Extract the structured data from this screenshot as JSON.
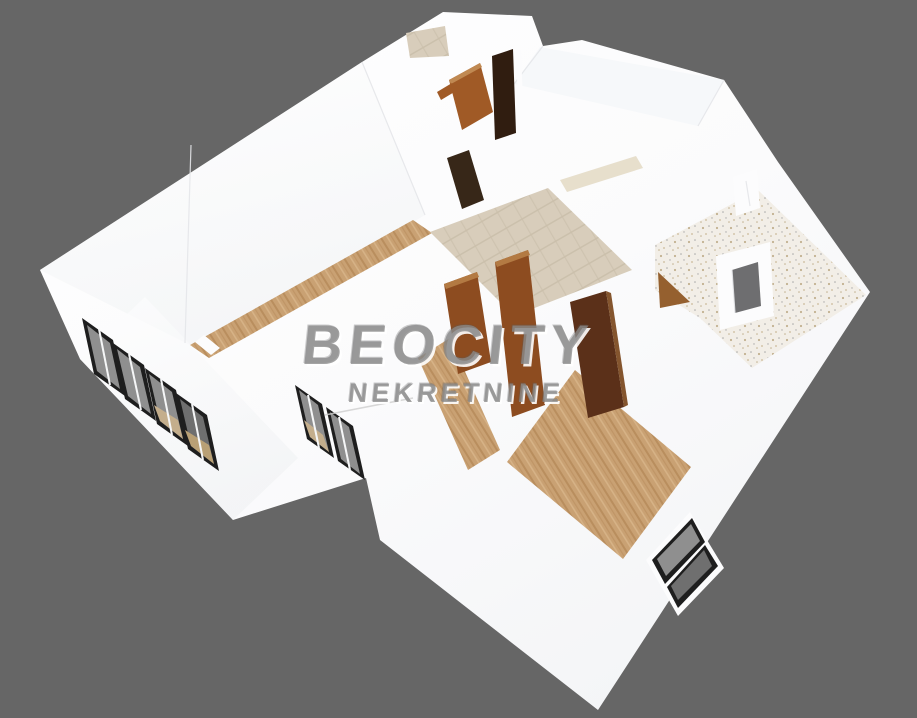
{
  "watermark": {
    "title": "BEOCITY",
    "subtitle": "NEKRETNINE"
  },
  "scene": {
    "type": "3d-floor-plan-render",
    "rooms_visible": "apartment interior with wood, tile and terrazzo floors, open wooden doors, window bands"
  },
  "palette": {
    "background": "#666666",
    "wall_bright": "#fcfcfd",
    "edge": "#e4e6e9",
    "sill": "#e7dfcc",
    "wood_base": "#c9a173",
    "wood_dark": "#b98e5e",
    "wood_light": "#d6b286",
    "tile_base": "#d8cdbb",
    "tile_line": "#cbc0ac",
    "terrazzo_base": "#f2eee7",
    "terrazzo_dot1": "#c2b190",
    "terrazzo_dot2": "#a9a9a9",
    "terrazzo_dot3": "#cbb998",
    "window_frame": "#1e1e1e",
    "window_hole": "#6e6e70",
    "glass": "#8f8f8f",
    "glass_dark": "#6f6f6f",
    "glass_warm": "#c4ae8c",
    "glass_warm2": "#b9a075",
    "mullion": "#f5f6f7",
    "door_oak": "#a05a26",
    "door_oak_light": "#c08952",
    "door_chestnut": "#8d4c20",
    "door_chestnut_light": "#b37a43",
    "door_mahogany": "#5b3019",
    "door_mahogany_light": "#84552e",
    "door_walnut": "#301d10",
    "door_dark_opening": "#372718",
    "door_tan": "#95602f",
    "watermark_fill": "rgba(138,138,138,0.78)",
    "watermark_hi": "rgba(255,255,255,0.9)",
    "watermark_dk": "rgba(90,90,90,0.3)",
    "watermark_slash": "#cfcfcf"
  }
}
